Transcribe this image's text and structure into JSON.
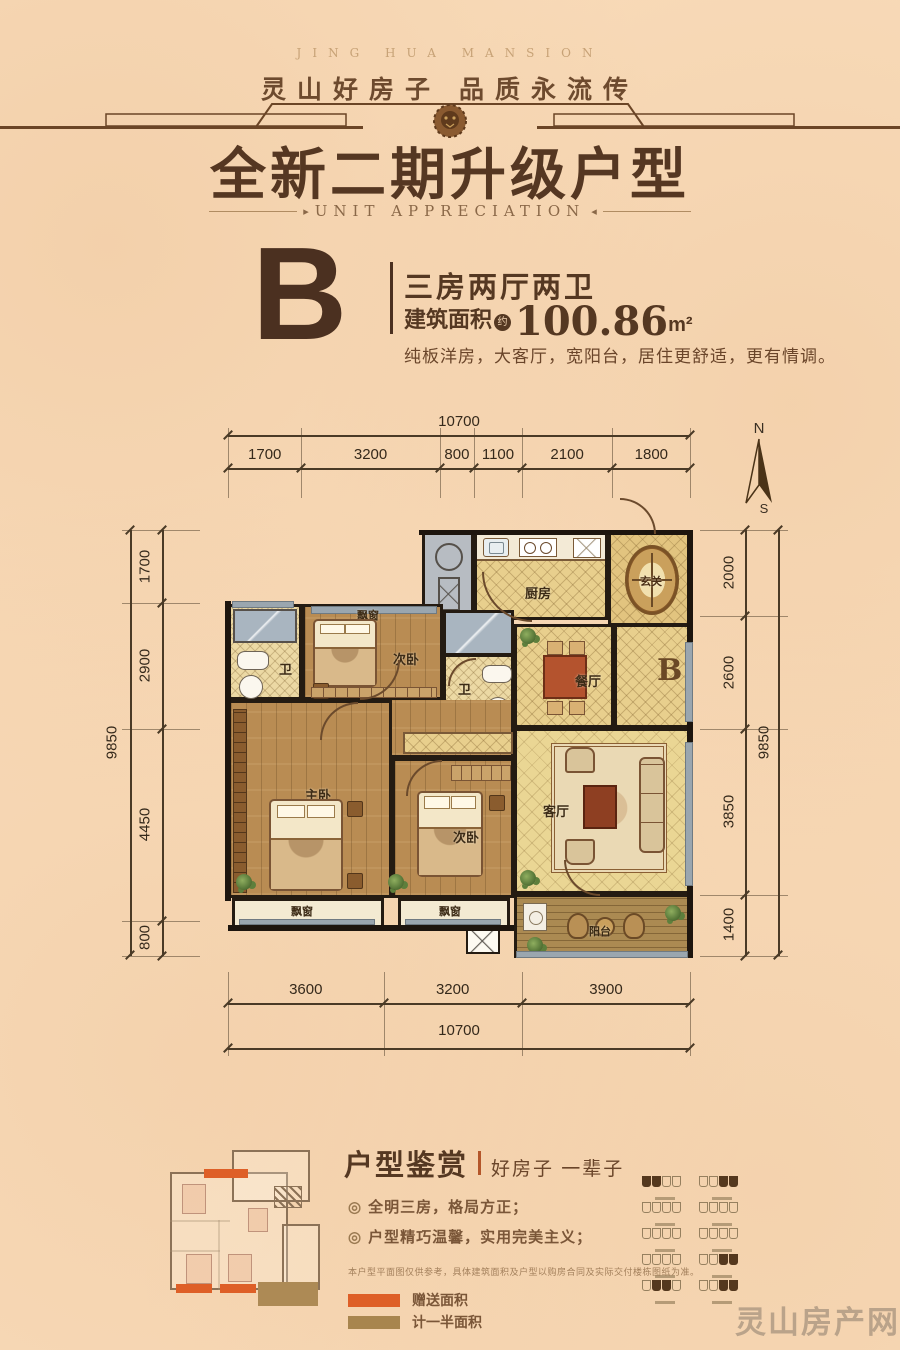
{
  "header": {
    "brand_en": "JING HUA MANSION",
    "tagline": "灵山好房子  品质永流传",
    "title": "全新二期升级户型",
    "subtitle": "UNIT APPRECIATION"
  },
  "unit": {
    "letter": "B",
    "layout": "三房两厅两卫",
    "area_label": "建筑面积",
    "area_approx": "约",
    "area_value": "100.86",
    "area_unit": "m²",
    "description": "纯板洋房，大客厅，宽阳台，居住更舒适，更有情调。"
  },
  "compass": {
    "north": "N",
    "south": "S"
  },
  "dimensions": {
    "top_total": "10700",
    "top_segments": [
      "1700",
      "3200",
      "800",
      "1100",
      "2100",
      "1800"
    ],
    "left_total": "9850",
    "left_segments": [
      "1700",
      "2900",
      "4450",
      "800"
    ],
    "right_total": "9850",
    "right_segments": [
      "2000",
      "2600",
      "3850",
      "1400"
    ],
    "bottom_total": "10700",
    "bottom_segments": [
      "3600",
      "3200",
      "3900"
    ]
  },
  "rooms": {
    "kitchen": "厨房",
    "entry": "玄关",
    "dining": "餐厅",
    "living": "客厅",
    "master": "主卧",
    "bedroom_a": "次卧",
    "bedroom_b": "次卧",
    "bath_a": "卫",
    "bath_b": "卫",
    "balcony": "阳台",
    "bay_window": "飘窗",
    "unit_mark": "B"
  },
  "appreciation": {
    "heading": "户型鉴赏",
    "heading_sub": "好房子 一辈子",
    "bullet_prefix": "◎",
    "bullets": [
      "全明三房，格局方正；",
      "户型精巧温馨，实用完美主义；"
    ],
    "disclaimer": "本户型平面图仅供参考，具体建筑面积及户型以购房合同及实际交付楼栋图纸为准。",
    "legend": [
      {
        "color": "#de5f27",
        "label": "赠送面积"
      },
      {
        "color": "#a8854e",
        "label": "计一半面积"
      }
    ]
  },
  "key_plans": [
    {
      "highlight": "left"
    },
    {
      "highlight": "right"
    },
    {
      "highlight": "none"
    },
    {
      "highlight": "none"
    },
    {
      "highlight": "none"
    },
    {
      "highlight": "none"
    },
    {
      "highlight": "none"
    },
    {
      "highlight": "right"
    },
    {
      "highlight": "center"
    },
    {
      "highlight": "right"
    }
  ],
  "watermark": "灵山房产网"
}
